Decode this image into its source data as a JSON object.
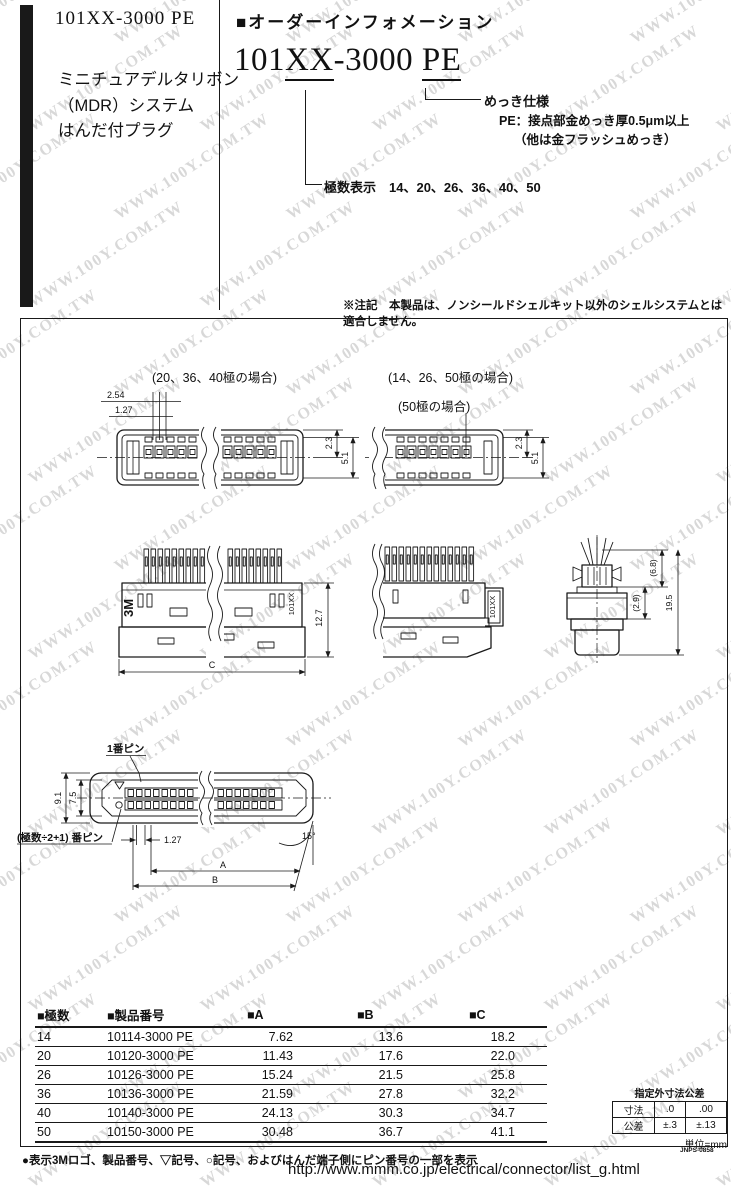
{
  "watermark": {
    "text": "WWW.100Y.COM.TW"
  },
  "header": {
    "part_number": "101XX-3000 PE",
    "subtitle_lines": [
      "ミニチュアデルタリボン",
      "（MDR）システム",
      "はんだ付プラグ"
    ]
  },
  "order_info": {
    "section_title": "■オーダーインフォメーション",
    "pn_base": "101",
    "pn_var": "XX",
    "pn_mid": "-3000",
    "pn_plate": "PE",
    "plating_label": "めっき仕様",
    "plating_line1": "PE：接点部金めっき厚0.5μm以上",
    "plating_line2": "（他は金フラッシュめっき）",
    "poles_label": "極数表示　14、20、26、36、40、50"
  },
  "note": "※注記　本製品は、ノンシールドシェルキット以外のシェルシステムとは適合しません。",
  "diagram": {
    "labels": {
      "case_left": "(20、36、40極の場合)",
      "case_right": "(14、26、50極の場合)",
      "case_50": "(50極の場合)"
    },
    "dims": {
      "pitch_254": "2.54",
      "pitch_127": "1.27",
      "h_23": "2.3",
      "h_51": "5.1",
      "h_127": "12.7",
      "dim_c": "C",
      "d_68": "(6.8)",
      "d_29": "(2.9)",
      "d_195": "19.5",
      "pin1_label": "1番ピン",
      "pinmid_label": "(極数÷2+1) 番ピン",
      "w_91": "9.1",
      "w_75": "7.5",
      "p_127": "1.27",
      "angle_15": "15°",
      "dim_a": "A",
      "dim_b": "B",
      "logo_3m": "3M",
      "model": "101XX"
    }
  },
  "table": {
    "headers": [
      "■極数",
      "■製品番号",
      "■A",
      "■B",
      "■C"
    ],
    "rows": [
      [
        "14",
        "10114-3000 PE",
        "7.62",
        "13.6",
        "18.2"
      ],
      [
        "20",
        "10120-3000 PE",
        "11.43",
        "17.6",
        "22.0"
      ],
      [
        "26",
        "10126-3000 PE",
        "15.24",
        "21.5",
        "25.8"
      ],
      [
        "36",
        "10136-3000 PE",
        "21.59",
        "27.8",
        "32.2"
      ],
      [
        "40",
        "10140-3000 PE",
        "24.13",
        "30.3",
        "34.7"
      ],
      [
        "50",
        "10150-3000 PE",
        "30.48",
        "36.7",
        "41.1"
      ]
    ]
  },
  "tolerance": {
    "title": "指定外寸法公差",
    "row1": [
      "寸法",
      ".0",
      ".00"
    ],
    "row2": [
      "公差",
      "±.3",
      "±.13"
    ],
    "unit": "単位=mm"
  },
  "footer": {
    "doc_code": "JNPS-0858",
    "note": "●表示3Mロゴ、製品番号、▽記号、○記号、およびはんだ端子側にピン番号の一部を表示",
    "url": "http://www.mmm.co.jp/electrical/connector/list_g.html"
  }
}
